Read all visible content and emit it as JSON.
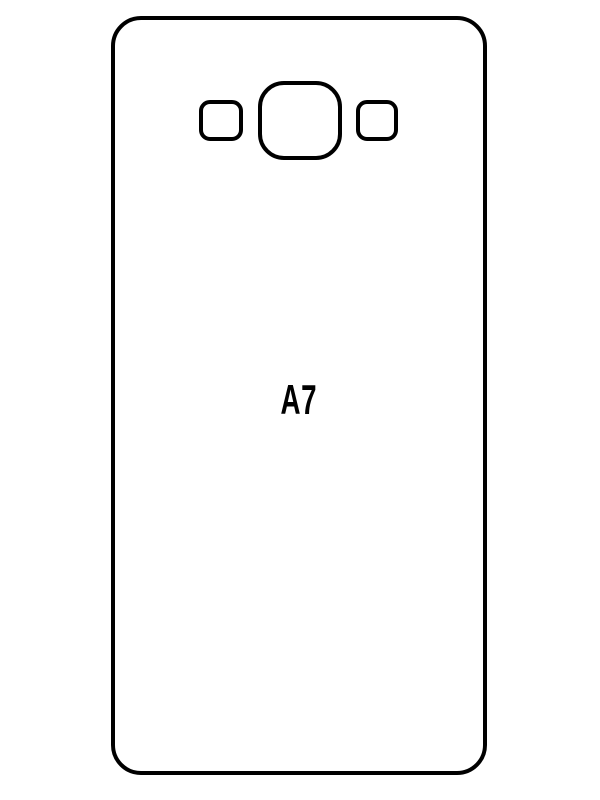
{
  "colors": {
    "background": "#ffffff",
    "line": "#000000",
    "text": "#000000"
  },
  "template": {
    "model_label": "A7"
  },
  "shapes": {
    "outline": "phone-back-outline",
    "cutouts": [
      "speaker-cutout",
      "camera-lens-cutout",
      "flash-cutout"
    ]
  }
}
